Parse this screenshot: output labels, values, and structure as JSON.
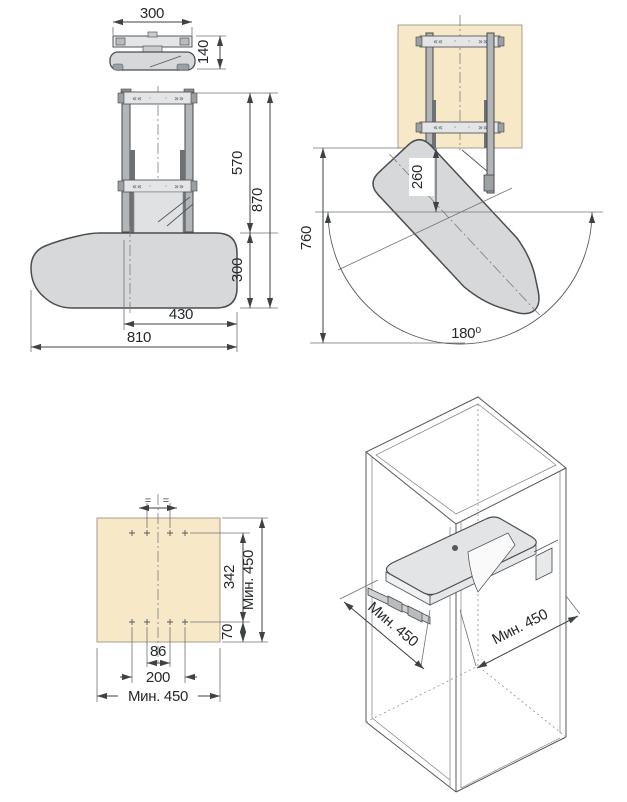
{
  "views": {
    "folded": {
      "width": "300",
      "height": "140"
    },
    "front": {
      "height_upper": "570",
      "height_total": "870",
      "board_width": "300",
      "width_inner": "430",
      "width_total": "810"
    },
    "swing": {
      "depth_below": "260",
      "clearance": "760",
      "angle": "180⁰"
    },
    "template": {
      "eq1": "=",
      "eq2": "=",
      "row_span": "342",
      "edge_offset": "70",
      "min_v": "Мин. 450",
      "inner": "86",
      "outer": "200",
      "min_h": "Мин. 450"
    },
    "cabinet": {
      "min_left": "Мин. 450",
      "min_right": "Мин. 450"
    }
  },
  "markings": {
    "arrows_left": "««",
    "arrows_right": "»»",
    "dot": "·"
  },
  "colors": {
    "panel": "#f7e9c7",
    "board": "#d7d8d9",
    "bracket": "#e4e5e6",
    "rail": "#b3b6b9",
    "rod": "#6e7174",
    "line": "#45484b"
  }
}
